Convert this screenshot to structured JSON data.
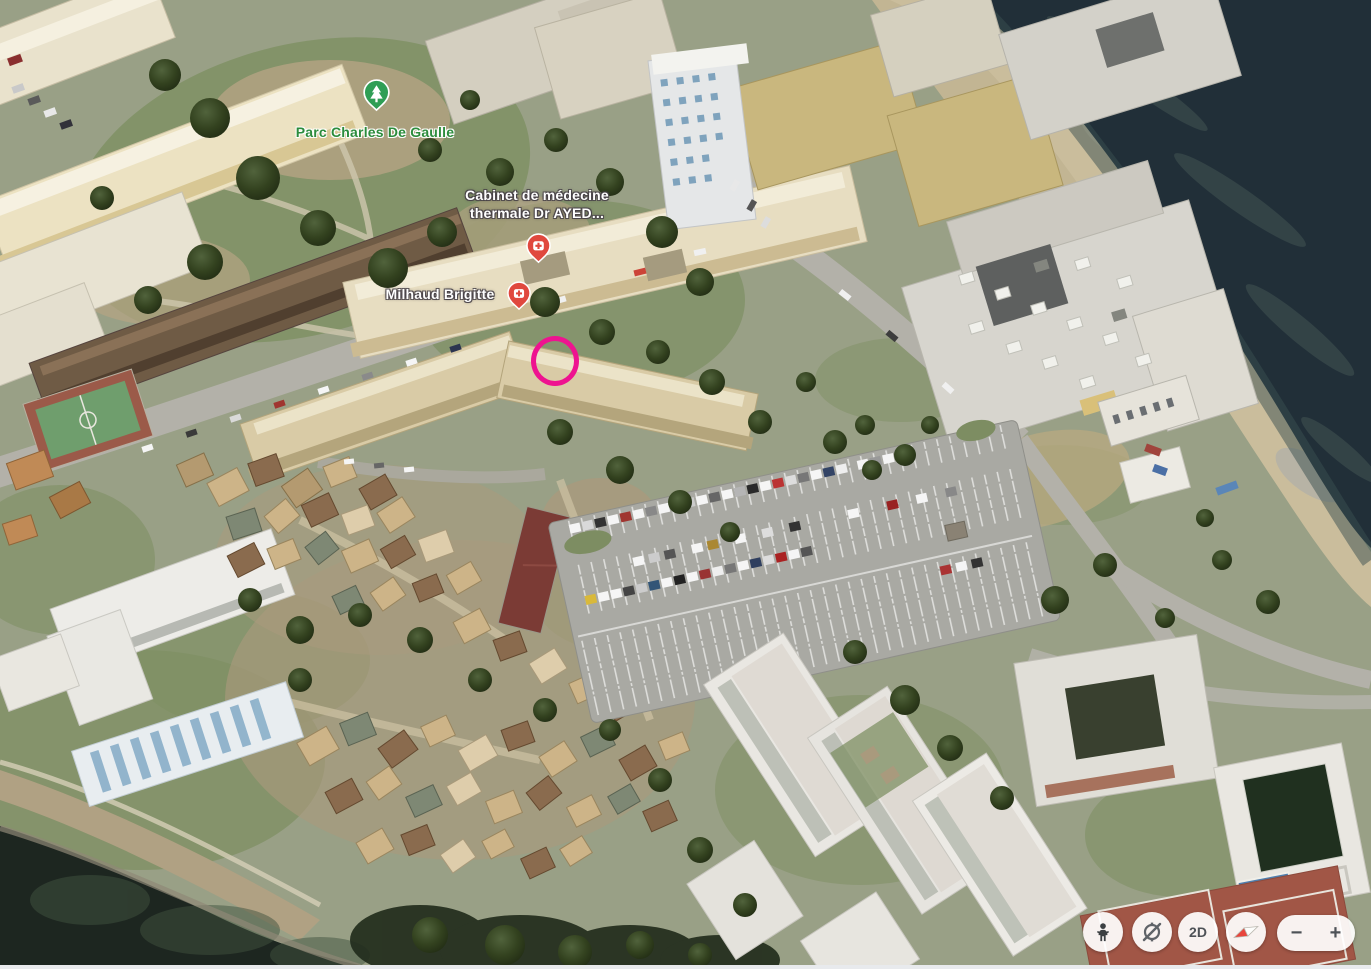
{
  "place_labels": {
    "park": {
      "text": "Parc Charles De Gaulle",
      "color": "#2c8c3c"
    },
    "clinic": {
      "line1": "Cabinet de médecine",
      "line2": "thermale Dr AYED...",
      "color": "#ffffff"
    },
    "person": {
      "text": "Milhaud Brigitte",
      "color": "#ffffff"
    }
  },
  "pins": {
    "park": {
      "icon": "park-pin-icon",
      "color": "#2f9e55"
    },
    "clinic": {
      "icon": "health-pin-icon",
      "color": "#e0483e"
    },
    "person": {
      "icon": "health-pin-icon",
      "color": "#e0483e"
    }
  },
  "annotation": {
    "shape": "ellipse-outline",
    "color": "#ee1390"
  },
  "controls": {
    "pegman": {
      "icon": "pegman-icon"
    },
    "rotate": {
      "icon": "orbit-rotate-icon"
    },
    "view_2d": {
      "label": "2D"
    },
    "compass": {
      "icon": "compass-needle-icon"
    },
    "zoom_out": {
      "label": "−"
    },
    "zoom_in": {
      "label": "+"
    }
  }
}
